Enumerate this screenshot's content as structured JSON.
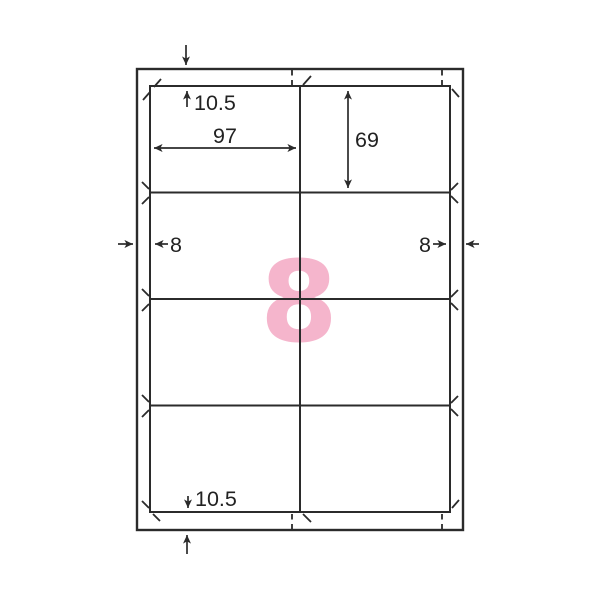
{
  "sheet": {
    "labels_per_sheet": "8",
    "grid": {
      "rows": 4,
      "columns": 2
    }
  },
  "dimensions": {
    "top_margin": "10.5",
    "bottom_margin": "10.5",
    "left_margin": "8",
    "right_margin": "8",
    "label_width": "97",
    "label_height": "69"
  },
  "colors": {
    "line": "#2b2b2b",
    "count_highlight": "#f5b5cc",
    "background": "#ffffff"
  }
}
